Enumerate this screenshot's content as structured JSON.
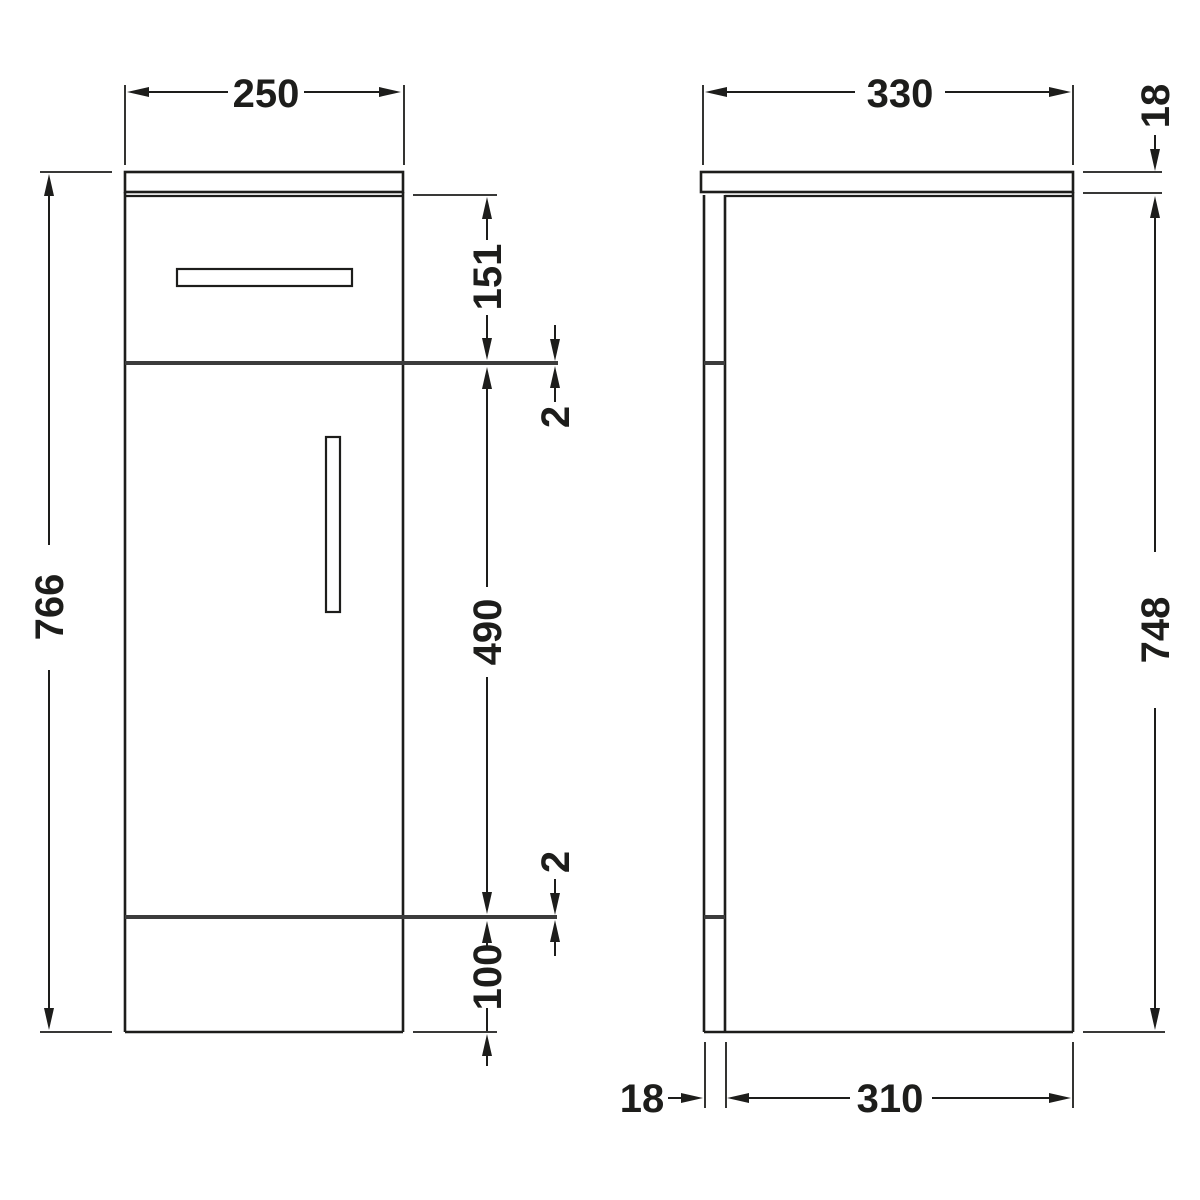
{
  "background": "#ffffff",
  "colors": {
    "line": "#1d1d1b",
    "divider": "#3c3c3c"
  },
  "drawing": {
    "front_view": {
      "dimensions": {
        "width": "250",
        "overall_height": "766",
        "drawer_front_height": "151",
        "top_gap": "2",
        "door_height": "490",
        "bottom_gap": "2",
        "plinth_height": "100"
      }
    },
    "side_view": {
      "dimensions": {
        "overall_depth": "330",
        "worktop_thickness": "18",
        "carcass_height": "748",
        "front_panel_thickness": "18",
        "carcass_depth": "310"
      }
    }
  }
}
